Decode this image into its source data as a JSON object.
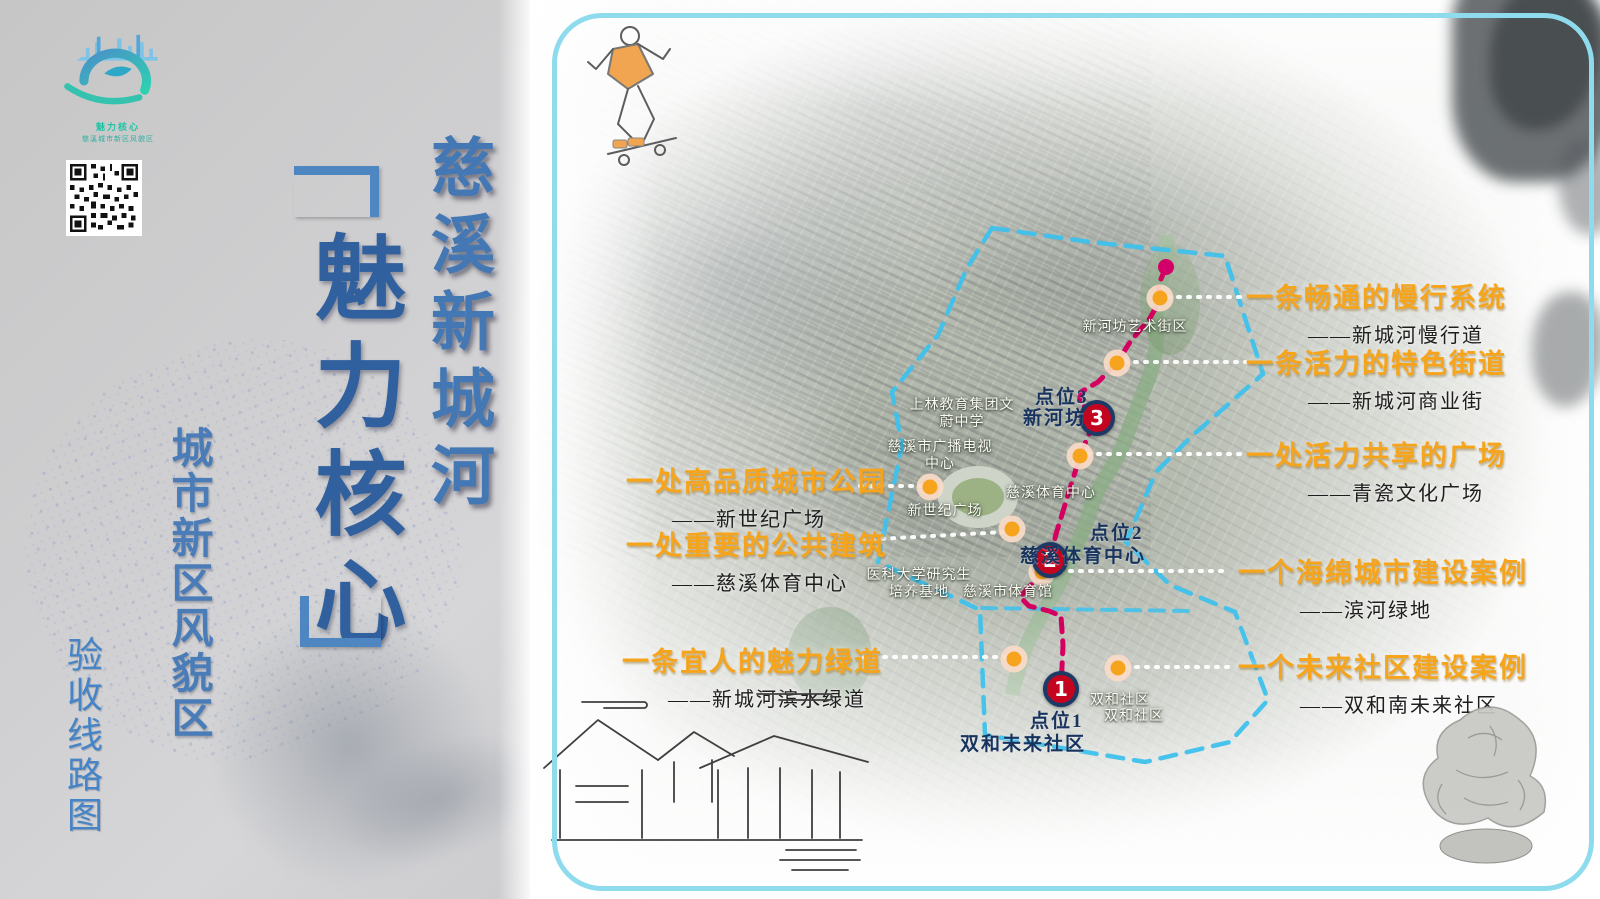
{
  "left_panel": {
    "logo": {
      "tagline_1": "魅力核心",
      "tagline_2": "慈溪城市新区风貌区"
    },
    "title_main": "慈溪新城河",
    "calligraphy": "魅力核心",
    "subtitle": "城市新区风貌区",
    "caption": "验收线路图"
  },
  "map": {
    "points": [
      {
        "num": "1",
        "line1": "点位1",
        "line2": "双和未来社区"
      },
      {
        "num": "2",
        "line1": "点位2",
        "line2": "慈溪体育中心"
      },
      {
        "num": "3",
        "line1": "点位3",
        "line2": "新河坊"
      }
    ],
    "annotations_right": [
      {
        "title": "一条畅通的慢行系统",
        "sub": "——新城河慢行道"
      },
      {
        "title": "一条活力的特色街道",
        "sub": "——新城河商业街"
      },
      {
        "title": "一处活力共享的广场",
        "sub": "——青瓷文化广场"
      },
      {
        "title": "一个海绵城市建设案例",
        "sub": "——滨河绿地"
      },
      {
        "title": "一个未来社区建设案例",
        "sub": "——双和南未来社区"
      }
    ],
    "annotations_left": [
      {
        "title": "一处高品质城市公园",
        "sub": "——新世纪广场"
      },
      {
        "title": "一处重要的公共建筑",
        "sub": "——慈溪体育中心"
      },
      {
        "title": "一条宜人的魅力绿道",
        "sub": "——新城河滨水绿道"
      }
    ],
    "place_labels": [
      "新河坊艺术街区",
      "上林教育集团文蔚中学",
      "慈溪市广播电视中心",
      "新世纪广场",
      "慈溪体育中心",
      "医科大学研究生培养基地",
      "慈溪市体育馆",
      "双和社区",
      "双和社区"
    ]
  },
  "colors": {
    "accent_orange": "#f5a41c",
    "route_pink": "#d4005f",
    "boundary_blue": "#3ec1ec",
    "marker_red": "#c3051f",
    "marker_ring_navy": "#1d3a66",
    "title_blue": "#4478b4",
    "frame_blue": "#8edbee"
  }
}
